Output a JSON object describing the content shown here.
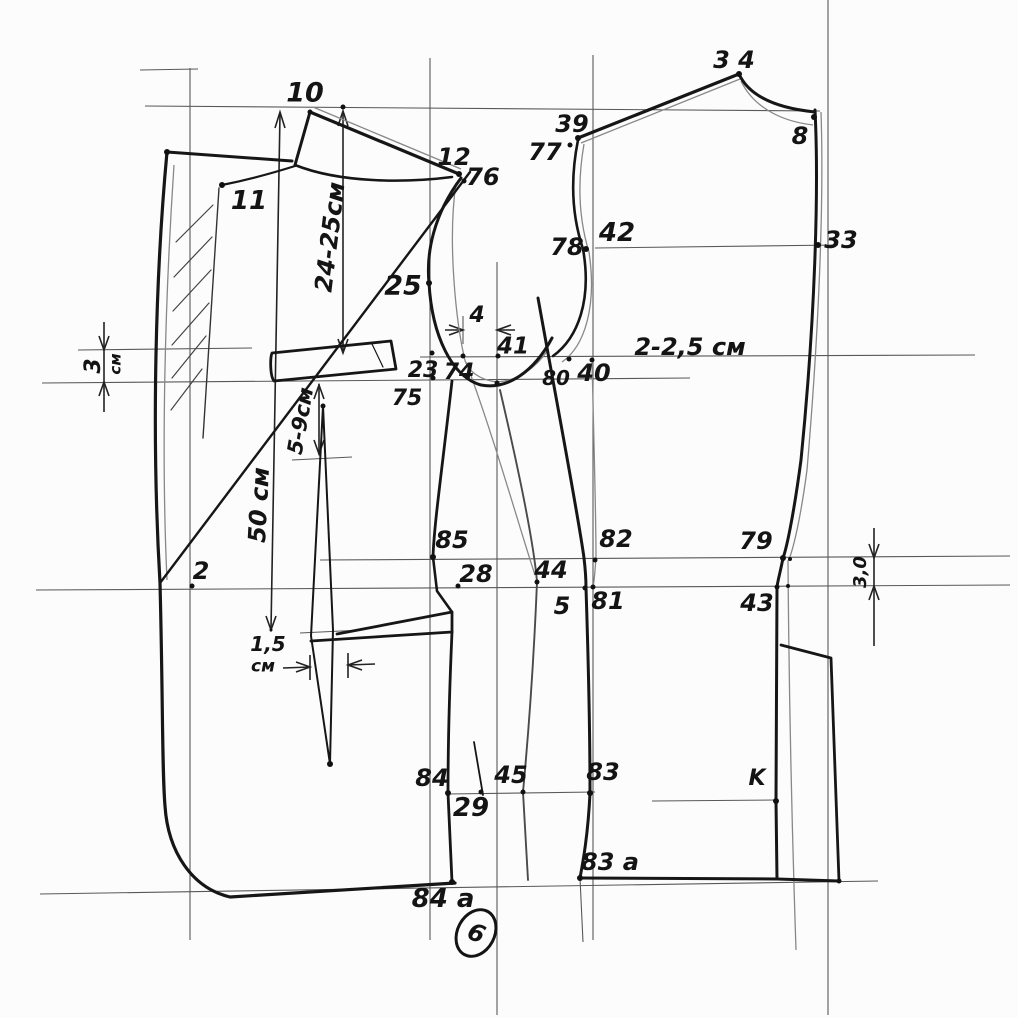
{
  "page": {
    "sheet_number": "6"
  },
  "diagram": {
    "kind": "hand-drawn tailoring pattern draft (jacket front, side body and back pieces)",
    "ink_color": "#161616",
    "construction_color": "#3c3c3c",
    "echo_color": "#888888",
    "points": [
      {
        "id": "10",
        "label": "10",
        "x": 305,
        "y": 93,
        "fs": 27
      },
      {
        "id": "11",
        "label": "11",
        "x": 249,
        "y": 201,
        "fs": 26
      },
      {
        "id": "12",
        "label": "12",
        "x": 454,
        "y": 157,
        "fs": 24
      },
      {
        "id": "76",
        "label": "76",
        "x": 483,
        "y": 177,
        "fs": 24
      },
      {
        "id": "25",
        "label": "25",
        "x": 403,
        "y": 286,
        "fs": 27
      },
      {
        "id": "23",
        "label": "23",
        "x": 423,
        "y": 371,
        "fs": 22
      },
      {
        "id": "75",
        "label": "75",
        "x": 407,
        "y": 399,
        "fs": 22
      },
      {
        "id": "74",
        "label": "74",
        "x": 459,
        "y": 373,
        "fs": 22
      },
      {
        "id": "41",
        "label": "41",
        "x": 513,
        "y": 347,
        "fs": 23
      },
      {
        "id": "4",
        "label": "4",
        "x": 477,
        "y": 316,
        "fs": 22
      },
      {
        "id": "80",
        "label": "80",
        "x": 556,
        "y": 378,
        "fs": 20
      },
      {
        "id": "40",
        "label": "40",
        "x": 594,
        "y": 373,
        "fs": 24
      },
      {
        "id": "chest-note",
        "label": "2-2,5 см",
        "x": 690,
        "y": 347,
        "fs": 24
      },
      {
        "id": "39",
        "label": "39",
        "x": 572,
        "y": 124,
        "fs": 24
      },
      {
        "id": "77",
        "label": "77",
        "x": 545,
        "y": 152,
        "fs": 24
      },
      {
        "id": "34",
        "label": "3 4",
        "x": 734,
        "y": 60,
        "fs": 24
      },
      {
        "id": "8",
        "label": "8",
        "x": 800,
        "y": 136,
        "fs": 24
      },
      {
        "id": "42",
        "label": "42",
        "x": 617,
        "y": 233,
        "fs": 26
      },
      {
        "id": "78",
        "label": "78",
        "x": 567,
        "y": 247,
        "fs": 24
      },
      {
        "id": "33",
        "label": "33",
        "x": 841,
        "y": 240,
        "fs": 24
      },
      {
        "id": "85",
        "label": "85",
        "x": 452,
        "y": 540,
        "fs": 24
      },
      {
        "id": "28",
        "label": "28",
        "x": 476,
        "y": 574,
        "fs": 24
      },
      {
        "id": "82",
        "label": "82",
        "x": 616,
        "y": 539,
        "fs": 24
      },
      {
        "id": "81",
        "label": "81",
        "x": 608,
        "y": 601,
        "fs": 24
      },
      {
        "id": "5",
        "label": "5",
        "x": 562,
        "y": 606,
        "fs": 24
      },
      {
        "id": "44",
        "label": "44",
        "x": 551,
        "y": 570,
        "fs": 24
      },
      {
        "id": "79",
        "label": "79",
        "x": 756,
        "y": 541,
        "fs": 24
      },
      {
        "id": "43",
        "label": "43",
        "x": 757,
        "y": 603,
        "fs": 24
      },
      {
        "id": "2",
        "label": "2",
        "x": 201,
        "y": 571,
        "fs": 24
      },
      {
        "id": "84",
        "label": "84",
        "x": 432,
        "y": 778,
        "fs": 24
      },
      {
        "id": "29",
        "label": "29",
        "x": 471,
        "y": 808,
        "fs": 26
      },
      {
        "id": "45",
        "label": "45",
        "x": 511,
        "y": 775,
        "fs": 24
      },
      {
        "id": "83",
        "label": "83",
        "x": 603,
        "y": 772,
        "fs": 24
      },
      {
        "id": "K",
        "label": "K",
        "x": 757,
        "y": 779,
        "fs": 22
      },
      {
        "id": "83a",
        "label": "83 a",
        "x": 610,
        "y": 862,
        "fs": 24
      },
      {
        "id": "84a",
        "label": "84 a",
        "x": 443,
        "y": 899,
        "fs": 26
      },
      {
        "id": "dart-width-val",
        "label": "1,5",
        "x": 268,
        "y": 644,
        "fs": 20
      },
      {
        "id": "dart-width-unit",
        "label": "см",
        "x": 263,
        "y": 667,
        "fs": 17
      }
    ],
    "rotated_measurements": [
      {
        "id": "lapel-length",
        "text": "24-25см",
        "x": 330,
        "y": 237,
        "rot": -83,
        "fs": 24
      },
      {
        "id": "front-length",
        "text": "50 см",
        "x": 259,
        "y": 505,
        "rot": -87,
        "fs": 24
      },
      {
        "id": "flap-drop",
        "text": "5-9см",
        "x": 301,
        "y": 421,
        "rot": -80,
        "fs": 21
      },
      {
        "id": "left-gap-val",
        "text": "3",
        "x": 94,
        "y": 366,
        "rot": -90,
        "fs": 22
      },
      {
        "id": "left-gap-unit",
        "text": "см",
        "x": 116,
        "y": 364,
        "rot": -90,
        "fs": 15
      },
      {
        "id": "right-gap",
        "text": "3,0",
        "x": 861,
        "y": 572,
        "rot": -90,
        "fs": 18
      }
    ],
    "dots": [
      [
        167,
        152,
        3
      ],
      [
        310,
        112,
        2.5
      ],
      [
        343,
        107,
        2.5
      ],
      [
        222,
        185,
        3
      ],
      [
        459,
        174,
        3
      ],
      [
        464,
        181,
        2.5
      ],
      [
        429,
        283,
        3
      ],
      [
        432,
        353,
        2.5
      ],
      [
        433,
        378,
        2.5
      ],
      [
        463,
        356,
        2.5
      ],
      [
        498,
        356,
        2.5
      ],
      [
        497,
        383,
        2.5
      ],
      [
        569,
        359,
        2.5
      ],
      [
        592,
        360,
        2.5
      ],
      [
        578,
        138,
        3
      ],
      [
        570,
        145,
        2.5
      ],
      [
        586,
        249,
        3
      ],
      [
        739,
        74,
        3
      ],
      [
        814,
        117,
        3
      ],
      [
        818,
        245,
        3
      ],
      [
        433,
        557,
        3
      ],
      [
        458,
        586,
        2.5
      ],
      [
        192,
        586,
        2.5
      ],
      [
        537,
        582,
        2.5
      ],
      [
        595,
        560,
        2.5
      ],
      [
        585,
        588,
        2.5
      ],
      [
        593,
        587,
        2.5
      ],
      [
        783,
        558,
        3
      ],
      [
        790,
        559,
        2
      ],
      [
        777,
        587,
        2.5
      ],
      [
        788,
        586,
        2
      ],
      [
        776,
        801,
        3
      ],
      [
        448,
        793,
        3
      ],
      [
        481,
        792,
        2.5
      ],
      [
        523,
        792,
        2.5
      ],
      [
        590,
        793,
        3
      ],
      [
        452,
        882,
        3
      ],
      [
        580,
        878,
        3
      ],
      [
        839,
        881,
        2.5
      ],
      [
        323,
        406,
        2.5
      ],
      [
        330,
        764,
        3
      ],
      [
        271,
        630,
        1.5
      ]
    ]
  }
}
